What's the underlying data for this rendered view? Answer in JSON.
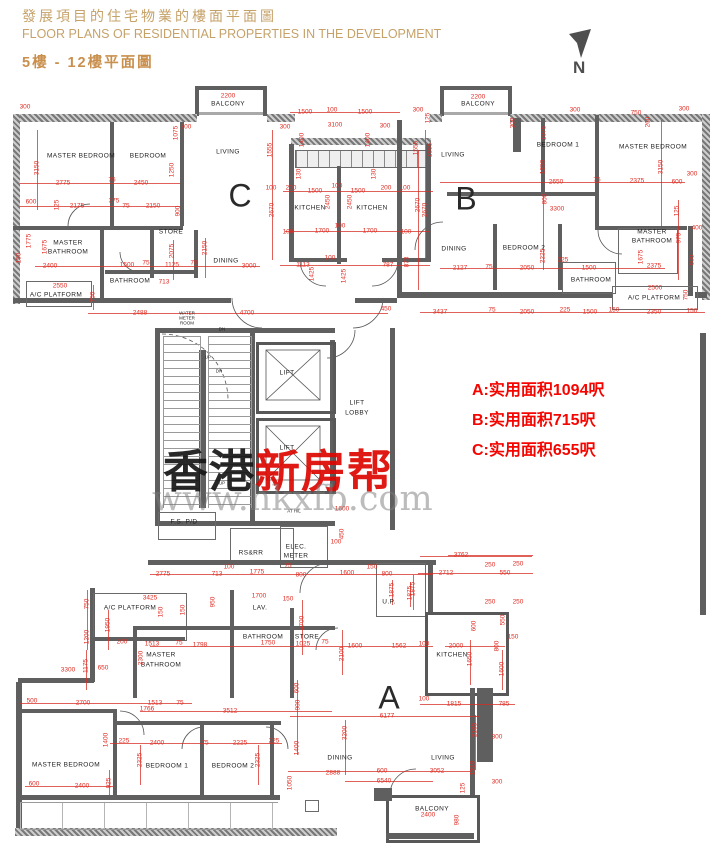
{
  "header": {
    "title_zh": "發展項目的住宅物業的樓面平面圖",
    "title_en": "FLOOR PLANS OF RESIDENTIAL PROPERTIES IN THE DEVELOPMENT",
    "subtitle": "5樓 - 12樓平面圖"
  },
  "compass": {
    "label": "N"
  },
  "areas": {
    "a": "A:实用面积1094呎",
    "b": "B:实用面积715呎",
    "c": "C:实用面积655呎"
  },
  "watermark": {
    "zh_black": "香港",
    "zh_red": "新房帮",
    "url": "www.hkxfb.com"
  },
  "colors": {
    "dim_red": "#e02b22",
    "header_tan": "#c6a269",
    "annotation_red": "#f50500",
    "wall_gray": "#5f5f5f"
  },
  "unit_letters": [
    [
      "C",
      240,
      196
    ],
    [
      "B",
      466,
      199
    ],
    [
      "A",
      389,
      698
    ]
  ],
  "room_labels": [
    [
      "MASTER BEDROOM",
      81,
      156
    ],
    [
      "BEDROOM",
      148,
      156
    ],
    [
      "LIVING",
      228,
      152
    ],
    [
      "BALCONY",
      228,
      104
    ],
    [
      "KITCHEN",
      310,
      208
    ],
    [
      "KITCHEN",
      372,
      208
    ],
    [
      "STORE",
      171,
      232
    ],
    [
      "MASTER",
      68,
      243
    ],
    [
      "BATHROOM",
      68,
      252
    ],
    [
      "BATHROOM",
      130,
      281
    ],
    [
      "A/C PLATFORM",
      56,
      295
    ],
    [
      "DINING",
      226,
      261
    ],
    [
      "WATER",
      187,
      313,
      "tiny"
    ],
    [
      "METER",
      187,
      318,
      "tiny"
    ],
    [
      "ROOM",
      187,
      323,
      "tiny"
    ],
    [
      "DN",
      222,
      329,
      "tiny"
    ],
    [
      "BALCONY",
      478,
      104
    ],
    [
      "LIVING",
      453,
      155
    ],
    [
      "BEDROOM 1",
      558,
      145
    ],
    [
      "MASTER BEDROOM",
      653,
      147
    ],
    [
      "DINING",
      454,
      249
    ],
    [
      "BEDROOM 2",
      524,
      248
    ],
    [
      "MASTER",
      652,
      232
    ],
    [
      "BATHROOM",
      652,
      241
    ],
    [
      "BATHROOM",
      591,
      280
    ],
    [
      "A/C PLATFORM",
      654,
      298
    ],
    [
      "LIFT",
      287,
      373
    ],
    [
      "LIFT",
      287,
      448
    ],
    [
      "LIFT",
      357,
      403
    ],
    [
      "LOBBY",
      357,
      413
    ],
    [
      "UP",
      208,
      357,
      "tiny"
    ],
    [
      "DN",
      219,
      371,
      "tiny"
    ],
    [
      "UP",
      222,
      483,
      "tiny"
    ],
    [
      "F.S. P/D",
      184,
      522
    ],
    [
      "AT H/L",
      294,
      511,
      "tiny"
    ],
    [
      "RS&RR",
      251,
      553
    ],
    [
      "ELEC.",
      296,
      547
    ],
    [
      "METER",
      296,
      556
    ],
    [
      "LAV.",
      260,
      608
    ],
    [
      "U.P.",
      389,
      602
    ],
    [
      "STORE",
      307,
      637
    ],
    [
      "BATHROOM",
      263,
      637
    ],
    [
      "MASTER",
      161,
      655
    ],
    [
      "BATHROOM",
      161,
      665
    ],
    [
      "A/C PLATFORM",
      130,
      608
    ],
    [
      "KITCHEN",
      452,
      655
    ],
    [
      "DINING",
      340,
      758
    ],
    [
      "LIVING",
      443,
      758
    ],
    [
      "MASTER BEDROOM",
      66,
      765
    ],
    [
      "BEDROOM 1",
      167,
      766
    ],
    [
      "BEDROOM 2",
      233,
      766
    ],
    [
      "BALCONY",
      432,
      809
    ]
  ],
  "dims": [
    [
      "2200",
      228,
      96
    ],
    [
      "2200",
      478,
      97
    ],
    [
      "300",
      25,
      107
    ],
    [
      "1075",
      176,
      133,
      1
    ],
    [
      "300",
      186,
      127
    ],
    [
      "3150",
      37,
      168,
      1
    ],
    [
      "1250",
      172,
      170,
      1
    ],
    [
      "2775",
      63,
      183
    ],
    [
      "75",
      112,
      180
    ],
    [
      "2450",
      141,
      183
    ],
    [
      "600",
      31,
      202
    ],
    [
      "125",
      57,
      205,
      1
    ],
    [
      "2175",
      77,
      206
    ],
    [
      "375",
      114,
      201
    ],
    [
      "75",
      126,
      206
    ],
    [
      "2150",
      153,
      206
    ],
    [
      "900",
      178,
      211,
      1
    ],
    [
      "1775",
      29,
      241,
      1
    ],
    [
      "1675",
      45,
      247,
      1
    ],
    [
      "2400",
      50,
      266
    ],
    [
      "150",
      19,
      258,
      1
    ],
    [
      "1500",
      127,
      265
    ],
    [
      "75",
      146,
      263
    ],
    [
      "1125",
      172,
      265
    ],
    [
      "75",
      194,
      263
    ],
    [
      "2075",
      172,
      251,
      1
    ],
    [
      "2150",
      205,
      248,
      1
    ],
    [
      "713",
      164,
      282
    ],
    [
      "2550",
      60,
      286
    ],
    [
      "750",
      93,
      297,
      1
    ],
    [
      "3000",
      249,
      266
    ],
    [
      "2488",
      140,
      313
    ],
    [
      "4700",
      247,
      313
    ],
    [
      "450",
      386,
      309
    ],
    [
      "1500",
      305,
      112
    ],
    [
      "100",
      332,
      110
    ],
    [
      "1500",
      365,
      112
    ],
    [
      "3100",
      335,
      125
    ],
    [
      "300",
      285,
      127
    ],
    [
      "300",
      385,
      126
    ],
    [
      "1400",
      302,
      140,
      1
    ],
    [
      "1400",
      368,
      140,
      1
    ],
    [
      "1555",
      270,
      150,
      1
    ],
    [
      "1555",
      430,
      150,
      1
    ],
    [
      "130",
      299,
      174,
      1
    ],
    [
      "130",
      374,
      174,
      1
    ],
    [
      "100",
      271,
      188
    ],
    [
      "200",
      291,
      188
    ],
    [
      "1500",
      315,
      191
    ],
    [
      "100",
      337,
      186
    ],
    [
      "1500",
      358,
      191
    ],
    [
      "200",
      386,
      188
    ],
    [
      "100",
      405,
      188
    ],
    [
      "2670",
      272,
      210,
      1
    ],
    [
      "2670",
      425,
      210,
      1
    ],
    [
      "2450",
      328,
      202,
      1
    ],
    [
      "2450",
      350,
      202,
      1
    ],
    [
      "100",
      340,
      226
    ],
    [
      "1700",
      322,
      231
    ],
    [
      "1700",
      370,
      231
    ],
    [
      "100",
      288,
      232
    ],
    [
      "100",
      406,
      232
    ],
    [
      "1113",
      303,
      265
    ],
    [
      "100",
      330,
      258
    ],
    [
      "787",
      388,
      265
    ],
    [
      "873",
      407,
      262,
      1
    ],
    [
      "1425",
      312,
      274,
      1
    ],
    [
      "1425",
      344,
      276,
      1
    ],
    [
      "300",
      418,
      110
    ],
    [
      "125",
      428,
      118,
      1
    ],
    [
      "300",
      513,
      123,
      1
    ],
    [
      "1075",
      544,
      133,
      1
    ],
    [
      "300",
      575,
      110
    ],
    [
      "750",
      636,
      113
    ],
    [
      "260",
      648,
      122,
      1
    ],
    [
      "300",
      684,
      109
    ],
    [
      "1555",
      416,
      148,
      1
    ],
    [
      "2650",
      556,
      182
    ],
    [
      "75",
      597,
      180
    ],
    [
      "2375",
      637,
      181
    ],
    [
      "600",
      677,
      182
    ],
    [
      "300",
      692,
      174
    ],
    [
      "3150",
      661,
      167,
      1
    ],
    [
      "1250",
      543,
      167,
      1
    ],
    [
      "2670",
      418,
      205,
      1
    ],
    [
      "800",
      545,
      199,
      1
    ],
    [
      "3300",
      557,
      209
    ],
    [
      "125",
      677,
      211,
      1
    ],
    [
      "2127",
      460,
      268
    ],
    [
      "75",
      489,
      267
    ],
    [
      "2050",
      527,
      268
    ],
    [
      "2225",
      543,
      256,
      1
    ],
    [
      "225",
      563,
      260
    ],
    [
      "1500",
      589,
      268
    ],
    [
      "2375",
      654,
      266
    ],
    [
      "975",
      679,
      238,
      1
    ],
    [
      "400",
      697,
      228
    ],
    [
      "500",
      692,
      260,
      1
    ],
    [
      "1675",
      641,
      257,
      1
    ],
    [
      "2500",
      655,
      288
    ],
    [
      "750",
      686,
      295,
      1
    ],
    [
      "3437",
      440,
      312
    ],
    [
      "75",
      492,
      310
    ],
    [
      "2050",
      527,
      312
    ],
    [
      "225",
      565,
      310
    ],
    [
      "1500",
      590,
      312
    ],
    [
      "150",
      614,
      310
    ],
    [
      "2350",
      654,
      312
    ],
    [
      "150",
      692,
      311
    ],
    [
      "1600",
      342,
      509
    ],
    [
      "450",
      342,
      534,
      1
    ],
    [
      "100",
      336,
      542
    ],
    [
      "2775",
      163,
      574
    ],
    [
      "713",
      217,
      574
    ],
    [
      "1775",
      257,
      572
    ],
    [
      "800",
      301,
      575
    ],
    [
      "1600",
      347,
      573
    ],
    [
      "150",
      372,
      567
    ],
    [
      "800",
      387,
      574
    ],
    [
      "100",
      229,
      567
    ],
    [
      "75",
      288,
      566
    ],
    [
      "1875",
      392,
      590,
      1
    ],
    [
      "1875",
      410,
      593,
      1
    ],
    [
      "950",
      213,
      602,
      1
    ],
    [
      "1700",
      259,
      596
    ],
    [
      "150",
      288,
      599
    ],
    [
      "2700",
      302,
      623,
      1
    ],
    [
      "1600",
      355,
      646
    ],
    [
      "1562",
      399,
      646
    ],
    [
      "2100",
      342,
      654,
      1
    ],
    [
      "1025",
      303,
      644
    ],
    [
      "75",
      325,
      642
    ],
    [
      "1750",
      268,
      643
    ],
    [
      "3762",
      461,
      555
    ],
    [
      "250",
      490,
      565
    ],
    [
      "250",
      518,
      564
    ],
    [
      "2712",
      446,
      573
    ],
    [
      "550",
      505,
      573
    ],
    [
      "1875",
      413,
      589,
      1
    ],
    [
      "250",
      490,
      602
    ],
    [
      "250",
      518,
      602
    ],
    [
      "600",
      474,
      626,
      1
    ],
    [
      "550",
      503,
      620,
      1
    ],
    [
      "150",
      513,
      637
    ],
    [
      "100",
      424,
      644
    ],
    [
      "2000",
      456,
      646
    ],
    [
      "800",
      497,
      646,
      1
    ],
    [
      "1650",
      470,
      659,
      1
    ],
    [
      "1600",
      502,
      669,
      1
    ],
    [
      "100",
      424,
      699
    ],
    [
      "1815",
      454,
      704
    ],
    [
      "785",
      504,
      704
    ],
    [
      "3425",
      150,
      598
    ],
    [
      "750",
      87,
      604,
      1
    ],
    [
      "1950",
      108,
      625,
      1
    ],
    [
      "150",
      161,
      612,
      1
    ],
    [
      "150",
      183,
      610,
      1
    ],
    [
      "1200",
      87,
      637,
      1
    ],
    [
      "200",
      122,
      642
    ],
    [
      "1513",
      152,
      644
    ],
    [
      "75",
      179,
      643
    ],
    [
      "1798",
      200,
      645
    ],
    [
      "650",
      103,
      668
    ],
    [
      "3300",
      68,
      670
    ],
    [
      "1175",
      86,
      666,
      1
    ],
    [
      "2300",
      141,
      658,
      1
    ],
    [
      "2700",
      83,
      703
    ],
    [
      "500",
      32,
      701
    ],
    [
      "1513",
      155,
      703
    ],
    [
      "75",
      180,
      703
    ],
    [
      "1766",
      147,
      709
    ],
    [
      "3512",
      230,
      711
    ],
    [
      "1400",
      106,
      740,
      1
    ],
    [
      "225",
      124,
      741
    ],
    [
      "2400",
      157,
      743
    ],
    [
      "75",
      205,
      743
    ],
    [
      "2225",
      240,
      743
    ],
    [
      "225",
      274,
      741
    ],
    [
      "2325",
      140,
      760,
      1
    ],
    [
      "2325",
      258,
      760,
      1
    ],
    [
      "925",
      109,
      783,
      1
    ],
    [
      "600",
      34,
      784
    ],
    [
      "2400",
      82,
      786
    ],
    [
      "6177",
      387,
      716
    ],
    [
      "3200",
      345,
      733,
      1
    ],
    [
      "2165",
      475,
      730,
      1
    ],
    [
      "900",
      298,
      705,
      1
    ],
    [
      "600",
      297,
      688,
      1
    ],
    [
      "1400",
      297,
      748,
      1
    ],
    [
      "2888",
      333,
      773
    ],
    [
      "600",
      382,
      771
    ],
    [
      "3052",
      437,
      771
    ],
    [
      "6540",
      384,
      781
    ],
    [
      "1310",
      473,
      768,
      1
    ],
    [
      "1050",
      290,
      783,
      1
    ],
    [
      "2400",
      428,
      815
    ],
    [
      "980",
      457,
      820,
      1
    ],
    [
      "125",
      463,
      788,
      1
    ],
    [
      "300",
      497,
      737
    ],
    [
      "300",
      497,
      782
    ]
  ]
}
